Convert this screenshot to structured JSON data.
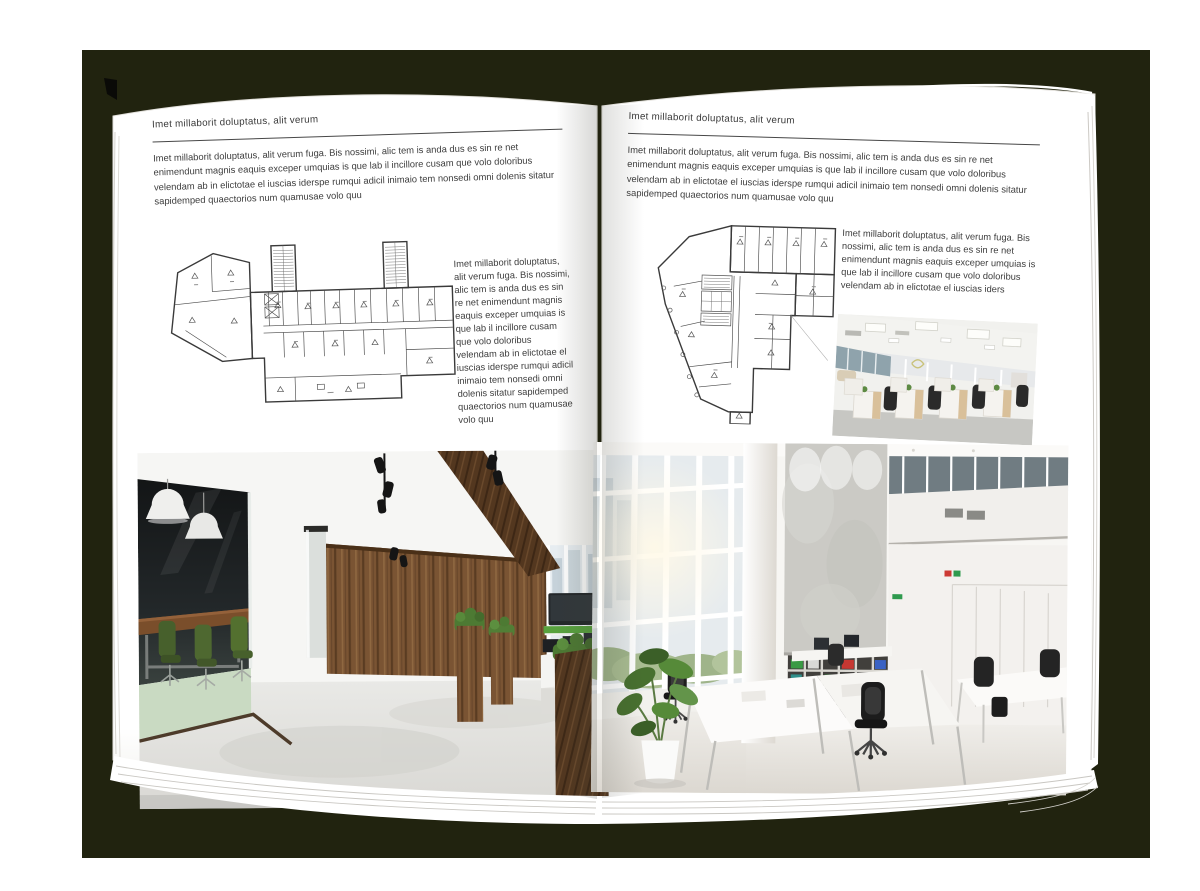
{
  "document": {
    "kind": "open-brochure-mockup",
    "colors": {
      "backdrop": "#21230f",
      "page": "#ffffff",
      "body_text": "#3d3d3d",
      "rule": "#474747",
      "plan_line": "#3a3a3a",
      "binder_green": "#3a9a44",
      "binder_red": "#c63732",
      "binder_blue": "#3a62c4",
      "chair_green": "#4e6630",
      "wood": "#7a5433"
    }
  },
  "pages": {
    "left": {
      "header": "Imet millaborit doluptatus, alit verum",
      "intro": "Imet millaborit doluptatus, alit verum fuga. Bis nossimi, alic tem is anda dus es sin re net enimendunt magnis eaquis exceper umquias is que lab il incillore cusam que volo doloribus velendam ab in elictotae el iuscias iderspe rumqui adicil inimaio tem nonsedi omni dolenis sitatur sapidemped quaectorios num quamusae volo quu",
      "side": "Imet millaborit doluptatus, alit verum fuga. Bis nossimi, alic tem is anda dus es sin re net enimendunt magnis eaquis exceper umquias is que lab il incillore cusam que volo doloribus velendam ab in elictotae el iuscias iderspe rumqui adicil inimaio tem nonsedi omni dolenis sitatur sapidemped quaectorios num quamusae volo quu",
      "floorplan": "wide-building-floor-plan",
      "photo": "dark-loft-office-with-glass-meeting-room"
    },
    "right": {
      "header": "Imet millaborit doluptatus, alit verum",
      "intro": "Imet millaborit doluptatus, alit verum fuga. Bis nossimi, alic tem is anda dus es sin re net enimendunt magnis eaquis exceper umquias is que lab il incillore cusam que volo doloribus velendam ab in elictotae el iuscias iderspe rumqui adicil inimaio tem nonsedi omni dolenis sitatur sapidemped quaectorios num quamusae volo quu",
      "side": "Imet millaborit doluptatus, alit verum fuga. Bis nossimi, alic tem is anda dus es sin re net enimendunt magnis eaquis exceper umquias is que lab il incillore cusam que volo doloribus velendam ab in elictotae el iuscias iders",
      "floorplan": "irregular-tower-floor-plan",
      "photo_small": "white-open-office-with-desk-rows",
      "photo_large": "double-height-office-with-binder-shelves"
    }
  }
}
